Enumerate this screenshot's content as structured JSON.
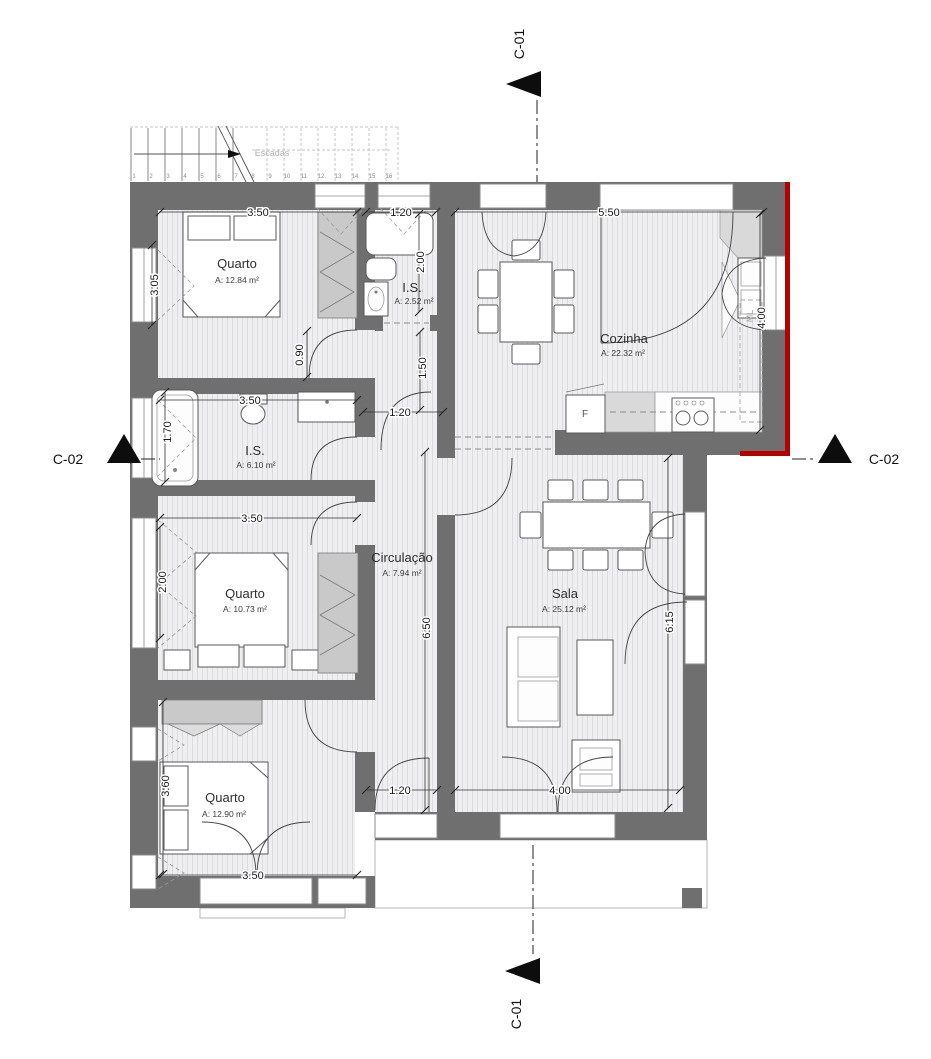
{
  "drawing": {
    "type": "residential floor plan",
    "section_top": "C-01",
    "section_bottom": "C-01",
    "section_left": "C-02",
    "section_right": "C-02"
  },
  "stairs": {
    "label": "Escadas",
    "numbers": [
      "1",
      "2",
      "3",
      "4",
      "5",
      "6",
      "7",
      "8",
      "9",
      "10",
      "11",
      "12",
      "13",
      "14",
      "15",
      "16"
    ]
  },
  "rooms": [
    {
      "name": "Quarto",
      "area": "A: 12.84 m²"
    },
    {
      "name": "I.S.",
      "area": "A: 2.52 m²"
    },
    {
      "name": "Cozinha",
      "area": "A: 22.32 m²"
    },
    {
      "name": "I.S.",
      "area": "A: 6.10 m²"
    },
    {
      "name": "Quarto",
      "area": "A: 10.73 m²"
    },
    {
      "name": "Circulação",
      "area": "A: 7.94 m²"
    },
    {
      "name": "Sala",
      "area": "A: 25.12 m²"
    },
    {
      "name": "Quarto",
      "area": "A: 12.90 m²"
    }
  ],
  "dimensions": [
    "3.50",
    "1.20",
    "5.50",
    "3.05",
    "2.00",
    "0.90",
    "1.50",
    "1.20",
    "4.00",
    "3.50",
    "1.70",
    "3.50",
    "2.00",
    "6.50",
    "6.15",
    "3.60",
    "1.20",
    "4.00",
    "3.50"
  ],
  "appliances": {
    "fridge_label": "F",
    "washer_label": "ML"
  },
  "colors": {
    "wall": "#6f6f6f",
    "accent_red": "#b50000",
    "floor_bg": "#efeff1",
    "floor_stripe": "#dcdcdf"
  }
}
